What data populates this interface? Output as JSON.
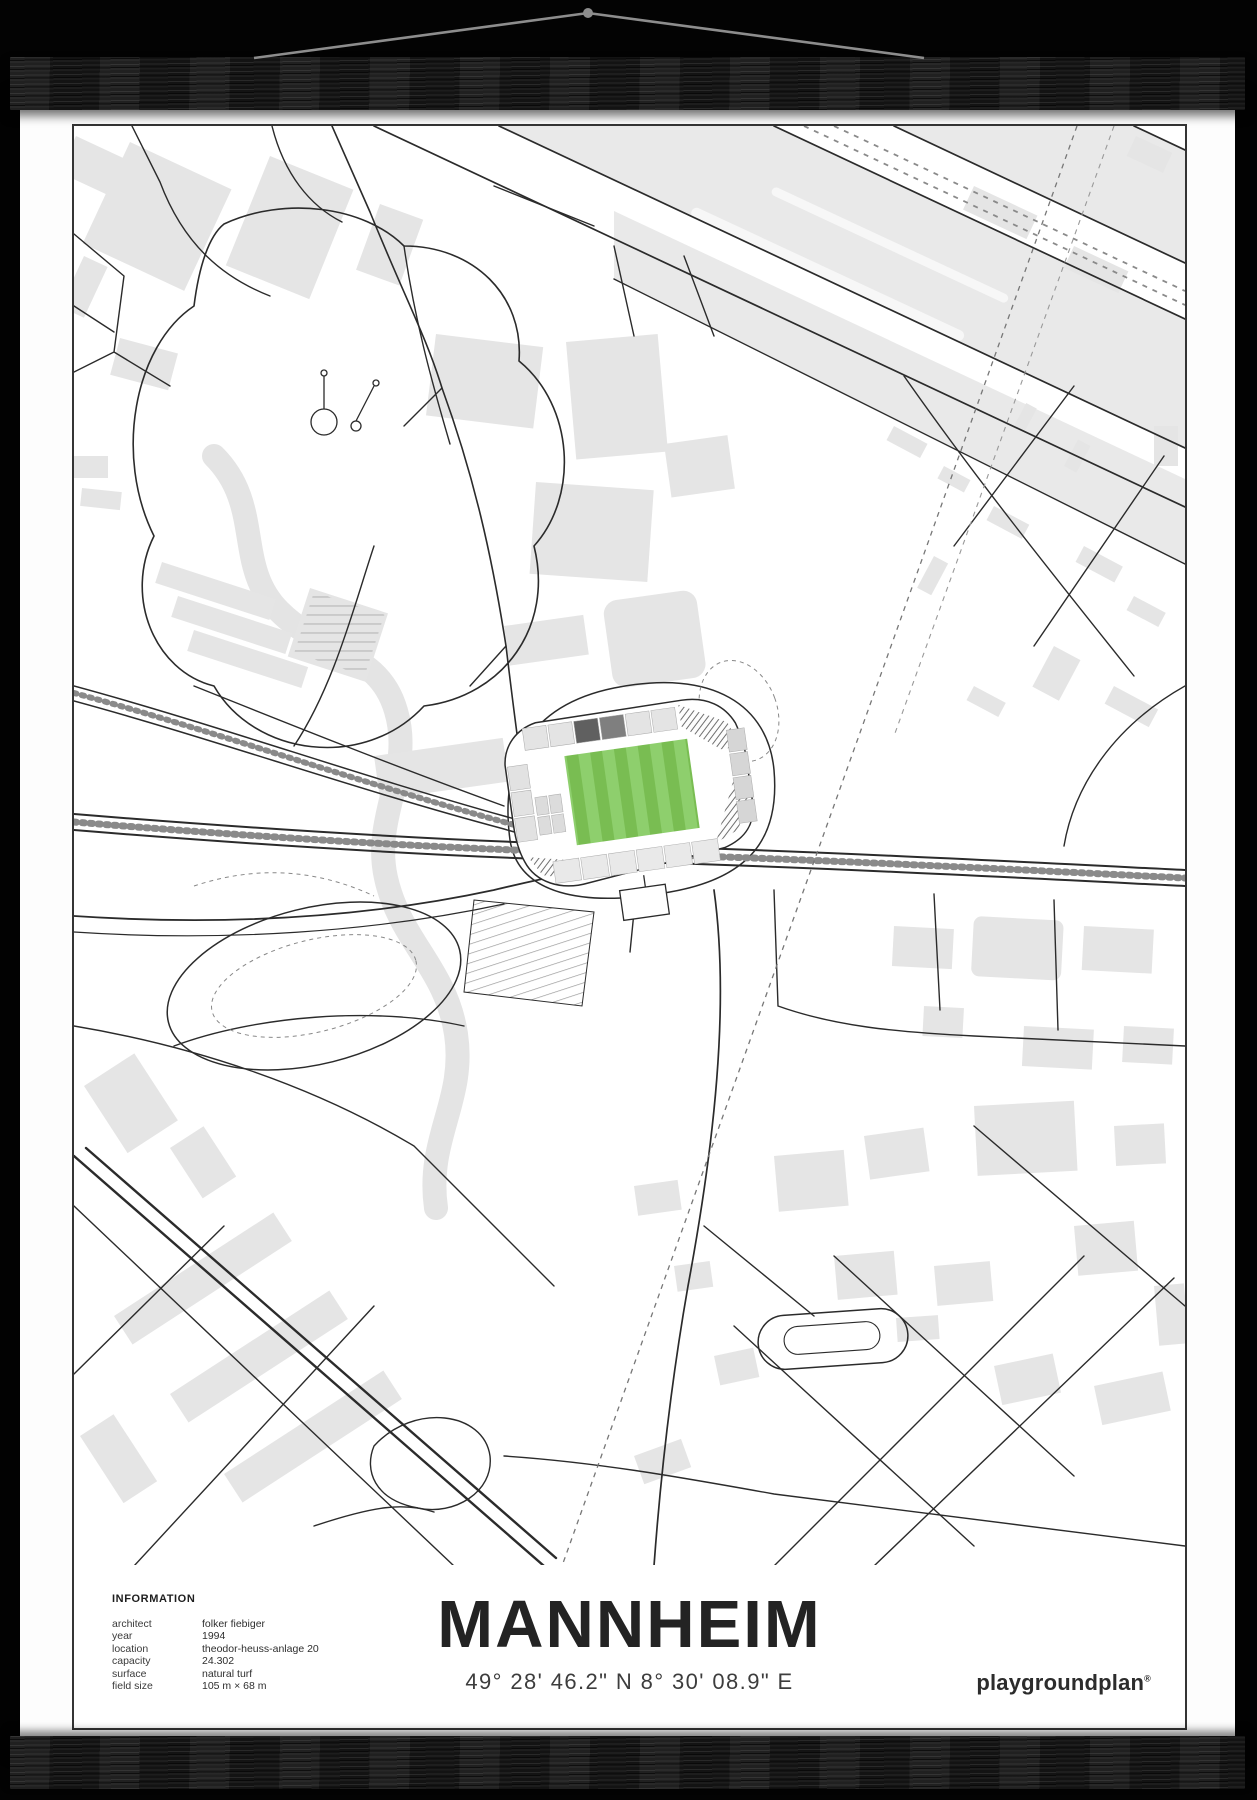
{
  "scene": {
    "hanger": {
      "string_color": "#8d8d8d",
      "rail_color": "#191919",
      "background_color": "#030303"
    }
  },
  "poster": {
    "map": {
      "pitch_color": "#79bd52",
      "pitch_stripe_color": "#8ecf6d",
      "building_color": "#e5e5e5",
      "band_color": "#e9e9e9",
      "road_color": "#2b2b2b",
      "stand_dark_color": "#606060",
      "stand_medium_color": "#7f7f7f",
      "stand_light_color": "#e4e4e4"
    },
    "caption": {
      "info": {
        "heading": "INFORMATION",
        "rows": [
          {
            "label": "architect",
            "value": "folker fiebiger"
          },
          {
            "label": "year",
            "value": "1994"
          },
          {
            "label": "location",
            "value": "theodor-heuss-anlage 20"
          },
          {
            "label": "capacity",
            "value": "24.302"
          },
          {
            "label": "surface",
            "value": "natural turf"
          },
          {
            "label": "field size",
            "value": "105 m × 68 m"
          }
        ]
      },
      "title": "MANNHEIM",
      "coordinates": "49° 28' 46.2\" N 8° 30' 08.9\" E",
      "brand": "playgroundplan",
      "brand_mark": "®"
    }
  }
}
